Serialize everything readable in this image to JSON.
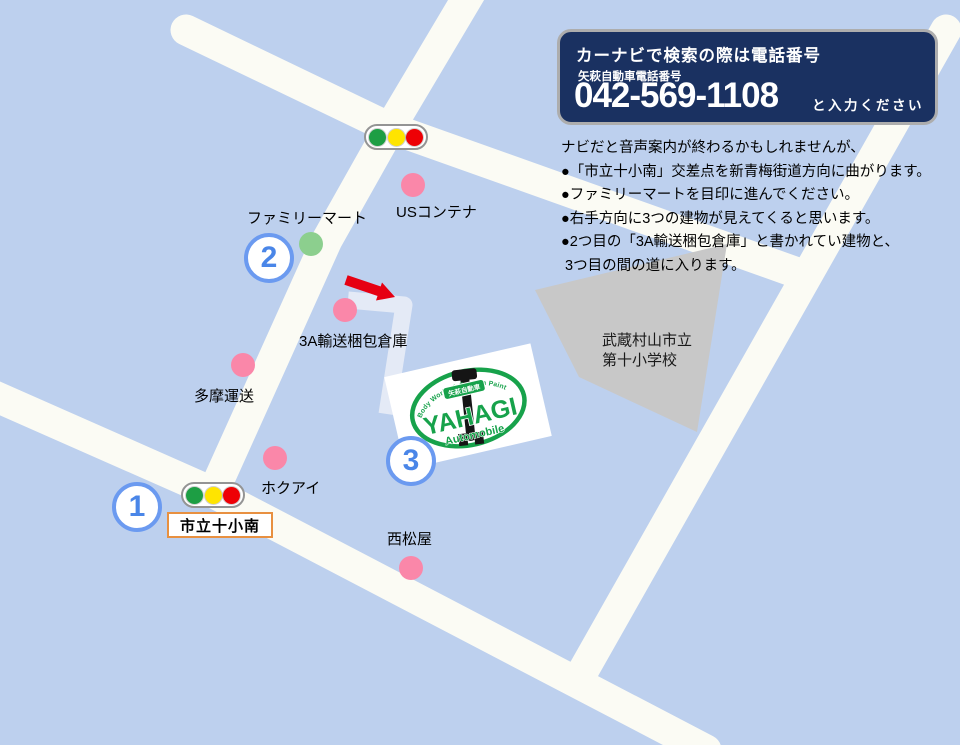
{
  "info_box": {
    "heading": "カーナビで検索の際は電話番号",
    "sub_label": "矢萩自動車電話番号",
    "phone_number": "042-569-1108",
    "phone_suffix": "と入力ください"
  },
  "instructions": {
    "lines": [
      "ナビだと音声案内が終わるかもしれませんが、",
      "●「市立十小南」交差点を新青梅街道方向に曲がります。",
      "●ファミリーマートを目印に進んでください。",
      "●右手方向に3つの建物が見えてくると思います。",
      "●2つ目の「3A輸送梱包倉庫」と書かれてい建物と、",
      " 3つ目の間の道に入ります。"
    ]
  },
  "map": {
    "landmarks": [
      {
        "label": "USコンテナ",
        "marker": "pink"
      },
      {
        "label": "ファミリーマート",
        "marker": "green"
      },
      {
        "label": "3A輸送梱包倉庫",
        "marker": "pink"
      },
      {
        "label": "多摩運送",
        "marker": "pink"
      },
      {
        "label": "ホクアイ",
        "marker": "pink"
      },
      {
        "label": "西松屋",
        "marker": "pink"
      }
    ],
    "intersection_sign": "市立十小南",
    "building_label_line1": "武蔵村山市立",
    "building_label_line2": "第十小学校",
    "route_markers": [
      "1",
      "2",
      "3"
    ],
    "traffic_light_count": "2"
  },
  "logo": {
    "arc_text": "Body Works & Custom Paint",
    "badge_text": "矢萩自動車",
    "name": "YAHAGI",
    "subtitle": "Automobile"
  },
  "colors": {
    "background": "#bdd0ee",
    "road": "#fbfbf4",
    "entry_road": "#e4eaf6",
    "building_gray": "#c8c8c8",
    "info_box_bg": "#1a3161",
    "marker_blue": "#4a86e8",
    "pink_dot": "#fa87a9",
    "green_dot": "#8ccf8e",
    "logo_green": "#17a24b",
    "arrow_red": "#e60012",
    "sign_border_orange": "#e89040"
  }
}
